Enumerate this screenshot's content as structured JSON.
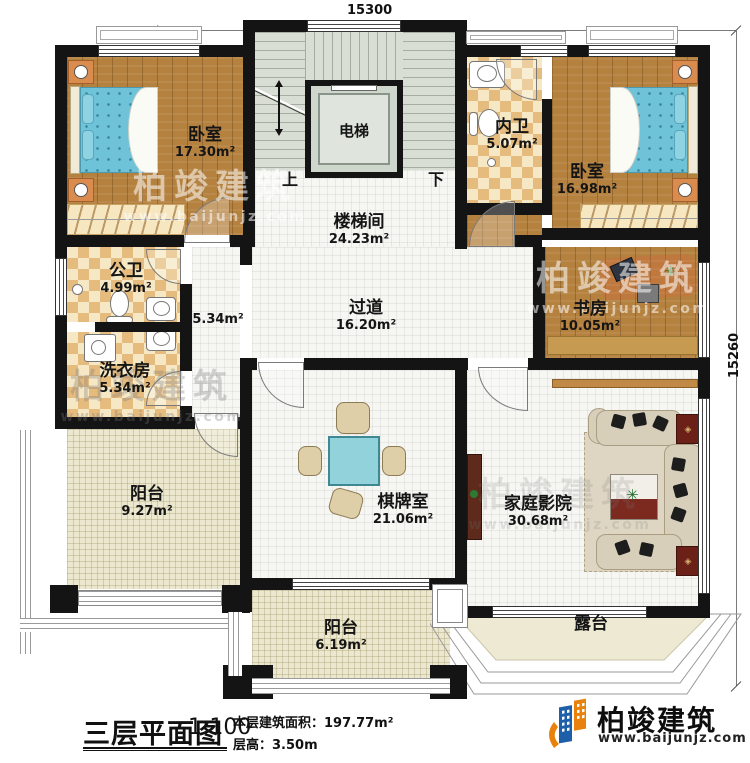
{
  "plan": {
    "dim_top": "15300",
    "dim_right": "15260",
    "stairs": {
      "up": "上",
      "down": "下"
    },
    "rooms": {
      "bedroom_left": {
        "name": "卧室",
        "area": "17.30m²"
      },
      "elevator": {
        "name": "电梯"
      },
      "stairwell": {
        "name": "楼梯间",
        "area": "24.23m²"
      },
      "inner_bath": {
        "name": "内卫",
        "area": "5.07m²"
      },
      "bedroom_right": {
        "name": "卧室",
        "area": "16.98m²"
      },
      "public_bath": {
        "name": "公卫",
        "area": "4.99m²"
      },
      "laundry": {
        "name": "洗衣房",
        "area": "5.34m²"
      },
      "hallway_west": {
        "area": "5.34m²"
      },
      "corridor": {
        "name": "过道",
        "area": "16.20m²"
      },
      "study": {
        "name": "书房",
        "area": "10.05m²"
      },
      "balcony_left": {
        "name": "阳台",
        "area": "9.27m²"
      },
      "game_room": {
        "name": "棋牌室",
        "area": "21.06m²"
      },
      "home_theater": {
        "name": "家庭影院",
        "area": "30.68m²"
      },
      "balcony_bottom": {
        "name": "阳台",
        "area": "6.19m²"
      },
      "terrace": {
        "name": "露台"
      }
    }
  },
  "title_block": {
    "title": "三层平面图",
    "scale": "1:100",
    "area_label": "本层建筑面积：",
    "area_value": "197.77m²",
    "floor_height_label": "层高：",
    "floor_height_value": "3.50m"
  },
  "brand": {
    "name": "柏竣建筑",
    "website": "www.baijunjz.com"
  },
  "watermark": {
    "name": "柏竣建筑",
    "website": "www.baijunjz.com"
  },
  "colors": {
    "wall": "#141414",
    "brand_orange": "#e8820c",
    "brand_blue": "#1d5fa8",
    "bed": "#6ec3d8"
  }
}
